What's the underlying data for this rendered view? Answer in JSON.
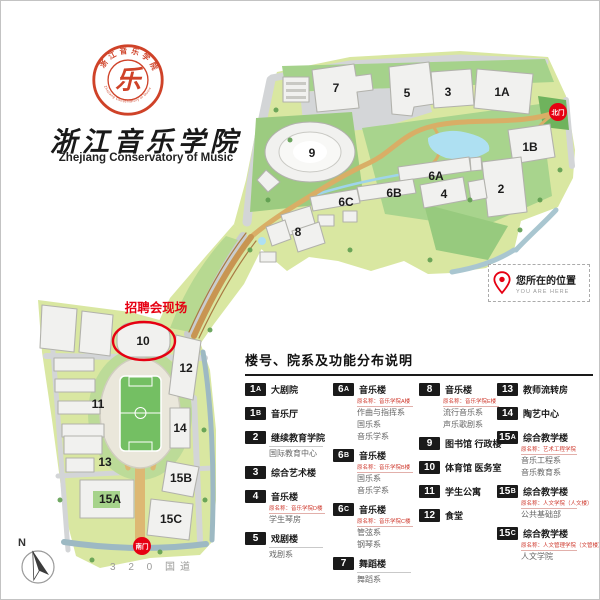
{
  "brand": {
    "seal_glyph": "乐",
    "seal_ring_top": "浙江音乐学院",
    "seal_ring_bottom": "Zhejiang Conservatory of Music",
    "title_cn": "浙江音乐学院",
    "title_en": "Zhejiang Conservatory of Music"
  },
  "colors": {
    "accent_red": "#e60012",
    "badge_black": "#1a1a1a",
    "ground_green": "#d9e7a1",
    "lake_blue": "#aee0f2"
  },
  "map": {
    "north_gate_label": "北门",
    "south_gate_label": "南门",
    "job_fair_label": "招聘会现场",
    "road_label": "3 2 0 国道",
    "compass_label": "N",
    "buildings": [
      {
        "label": "7",
        "x": 336,
        "y": 88
      },
      {
        "label": "5",
        "x": 407,
        "y": 93
      },
      {
        "label": "3",
        "x": 448,
        "y": 92
      },
      {
        "label": "1A",
        "x": 502,
        "y": 92
      },
      {
        "label": "1B",
        "x": 530,
        "y": 147
      },
      {
        "label": "2",
        "x": 501,
        "y": 189
      },
      {
        "label": "9",
        "x": 312,
        "y": 153
      },
      {
        "label": "6A",
        "x": 436,
        "y": 176
      },
      {
        "label": "4",
        "x": 444,
        "y": 194
      },
      {
        "label": "6B",
        "x": 394,
        "y": 193
      },
      {
        "label": "6C",
        "x": 346,
        "y": 202
      },
      {
        "label": "8",
        "x": 298,
        "y": 232
      },
      {
        "label": "10",
        "x": 143,
        "y": 341
      },
      {
        "label": "12",
        "x": 186,
        "y": 368
      },
      {
        "label": "11",
        "x": 98,
        "y": 404
      },
      {
        "label": "14",
        "x": 180,
        "y": 428
      },
      {
        "label": "13",
        "x": 105,
        "y": 462
      },
      {
        "label": "15A",
        "x": 110,
        "y": 499
      },
      {
        "label": "15B",
        "x": 181,
        "y": 478
      },
      {
        "label": "15C",
        "x": 171,
        "y": 519
      }
    ]
  },
  "you_are_here": {
    "label_cn": "您所在的位置",
    "label_en": "YOU ARE HERE"
  },
  "legend": {
    "title": "楼号、院系及功能分布说明",
    "columns": [
      [
        {
          "code": "1A",
          "name": "大剧院"
        },
        {
          "code": "1B",
          "name": "音乐厅"
        },
        {
          "code": "2",
          "name": "继续教育学院",
          "departments": [
            "国际教育中心"
          ]
        },
        {
          "code": "3",
          "name": "综合艺术楼"
        },
        {
          "code": "4",
          "name": "音乐楼",
          "original": "原名称：音乐学院D楼",
          "departments": [
            "学生琴房"
          ]
        },
        {
          "code": "5",
          "name": "戏剧楼",
          "departments": [
            "戏剧系"
          ]
        }
      ],
      [
        {
          "code": "6A",
          "name": "音乐楼",
          "original": "原名称：音乐学院A楼",
          "departments": [
            "作曲与指挥系",
            "国乐系",
            "音乐学系"
          ]
        },
        {
          "code": "6B",
          "name": "音乐楼",
          "original": "原名称：音乐学院B楼",
          "departments": [
            "国乐系",
            "音乐学系"
          ]
        },
        {
          "code": "6C",
          "name": "音乐楼",
          "original": "原名称：音乐学院C楼",
          "departments": [
            "管弦系",
            "钢琴系"
          ]
        },
        {
          "code": "7",
          "name": "舞蹈楼",
          "departments": [
            "舞蹈系"
          ]
        }
      ],
      [
        {
          "code": "8",
          "name": "音乐楼",
          "original": "原名称：音乐学院E楼",
          "departments": [
            "流行音乐系",
            "声乐歌剧系"
          ]
        },
        {
          "code": "9",
          "name": "图书馆 行政楼"
        },
        {
          "code": "10",
          "name": "体育馆 医务室"
        },
        {
          "code": "11",
          "name": "学生公寓"
        },
        {
          "code": "12",
          "name": "食堂"
        }
      ],
      [
        {
          "code": "13",
          "name": "教师流转房"
        },
        {
          "code": "14",
          "name": "陶艺中心"
        },
        {
          "code": "15A",
          "name": "综合教学楼",
          "original": "原名称：艺术工程学院",
          "departments": [
            "音乐工程系",
            "音乐教育系"
          ]
        },
        {
          "code": "15B",
          "name": "综合教学楼",
          "original": "原名称：人文学院（人文楼）",
          "departments": [
            "公共基础部"
          ]
        },
        {
          "code": "15C",
          "name": "综合教学楼",
          "original": "原名称：人文管理学院（文管楼）",
          "departments": [
            "人文学院"
          ]
        }
      ]
    ]
  }
}
